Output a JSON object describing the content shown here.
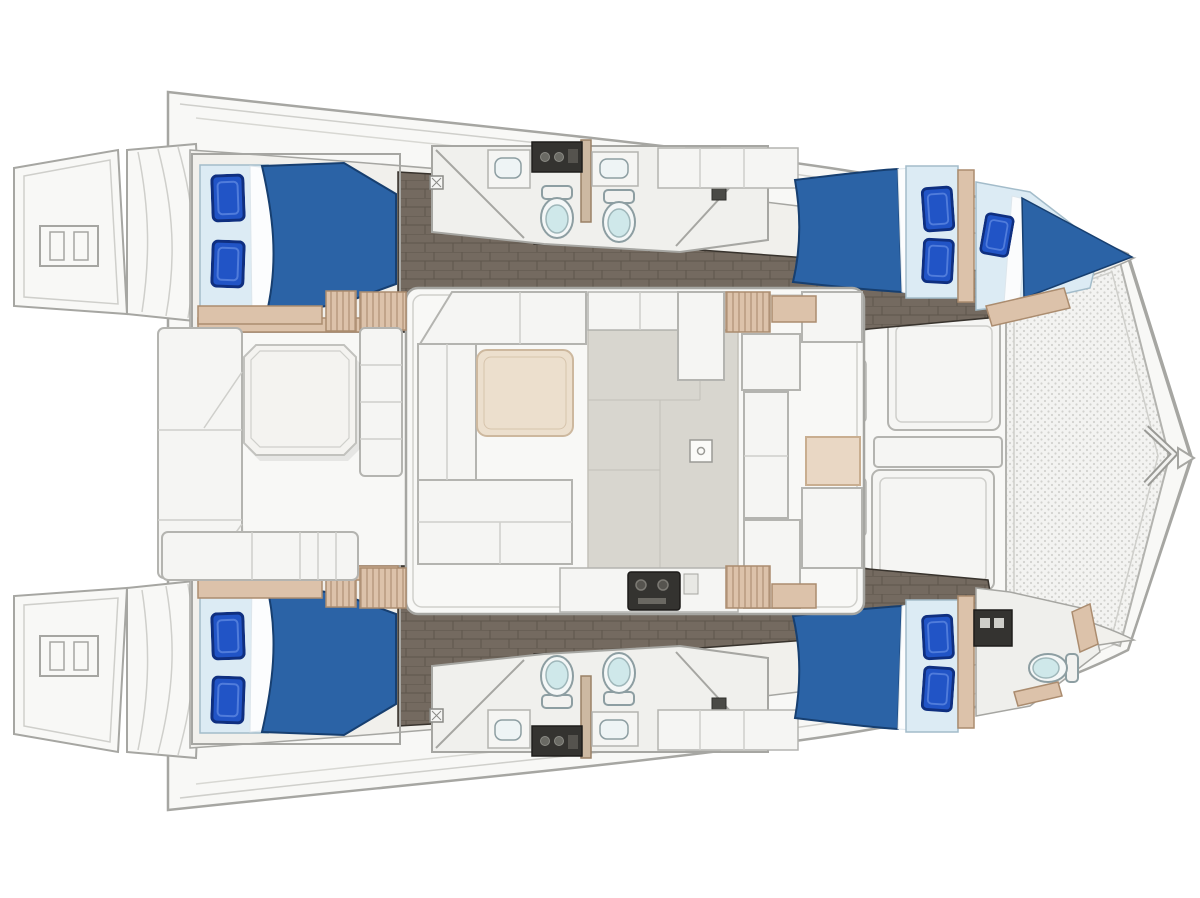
{
  "meta": {
    "description": "Top-down interior floor plan of a sailing catamaran, bow pointing right, stern swim platforms at left",
    "figure_type": "yacht deck / cabin layout plan"
  },
  "colors": {
    "bg": "#ffffff",
    "deck": "#f8f8f6",
    "deck2": "#f1f0ec",
    "line": "#a6a6a2",
    "line-light": "#cfcfcb",
    "furn": "#f5f5f3",
    "furn-line": "#b4b4b0",
    "gray-floor": "#d8d6cf",
    "gray-floor-line": "#c2c0b8",
    "floor-dark": "#746a60",
    "floor-dark-line": "#5e564c",
    "floor-edge": "#38332d",
    "beige": "#dcc2aa",
    "beige-line": "#ab8c6f",
    "duvet": "#2b63a6",
    "duvet-edge": "#173f70",
    "pillow": "#2154c6",
    "pillow-edge": "#0f2f80",
    "pillow-hi": "#5d86e0",
    "sheet": "#dcebf4",
    "sheet-line": "#a3bcca",
    "seat": "#cfe8ea",
    "fixline": "#8d9ea2",
    "appliance": "#343330",
    "appliance-hi": "#8b8b85",
    "tramp": "#f3f3f1",
    "dot": "#d2d2ce",
    "table-beige": "#ecdfcd",
    "table-beige-line": "#cdb89e"
  },
  "inventory": {
    "orientation": "bow right / stern left",
    "cabins": [
      {
        "name": "port aft cabin",
        "bed": "double",
        "pillows": 2
      },
      {
        "name": "port forward cabin",
        "bed": "double",
        "pillows": 2
      },
      {
        "name": "port bow berth",
        "bed": "single",
        "pillows": 1
      },
      {
        "name": "starboard aft cabin",
        "bed": "double",
        "pillows": 2
      },
      {
        "name": "starboard forward cabin",
        "bed": "double",
        "pillows": 2
      }
    ],
    "bathrooms": {
      "count": 5,
      "toilets": 5,
      "sinks": 4
    },
    "salon": {
      "sofa": "U-shaped",
      "tables": 1,
      "galley_stove": 1
    },
    "cockpit": {
      "tables": 1,
      "benches": 3
    },
    "deck": {
      "trampoline": 1,
      "swim_platforms": 2,
      "boarding_ladders": 2,
      "foredeck_hatches": 3,
      "companionway_stairs": 4
    }
  }
}
